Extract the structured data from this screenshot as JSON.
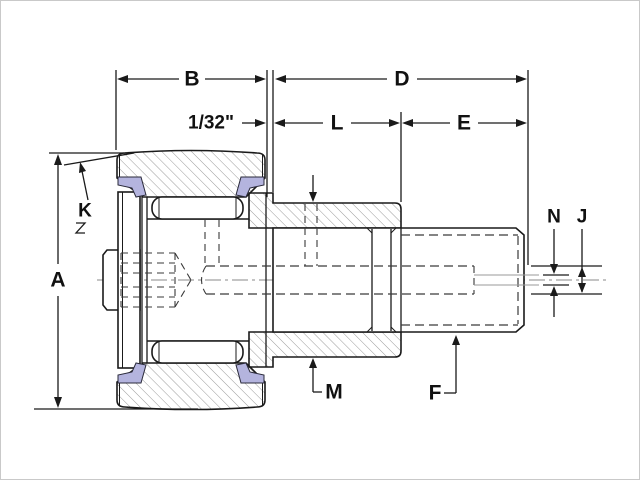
{
  "drawing": {
    "type": "cam-follower-bearing-cross-section",
    "labels": {
      "a": "A",
      "b": "B",
      "d": "D",
      "gap": "1/32\"",
      "l": "L",
      "e": "E",
      "k": "K",
      "n": "N",
      "j": "J",
      "m": "M",
      "f": "F"
    },
    "colors": {
      "line": "#1a1a1a",
      "hatch": "#9b9b9b",
      "seal": "#b4b4de",
      "background": "#ffffff"
    }
  }
}
